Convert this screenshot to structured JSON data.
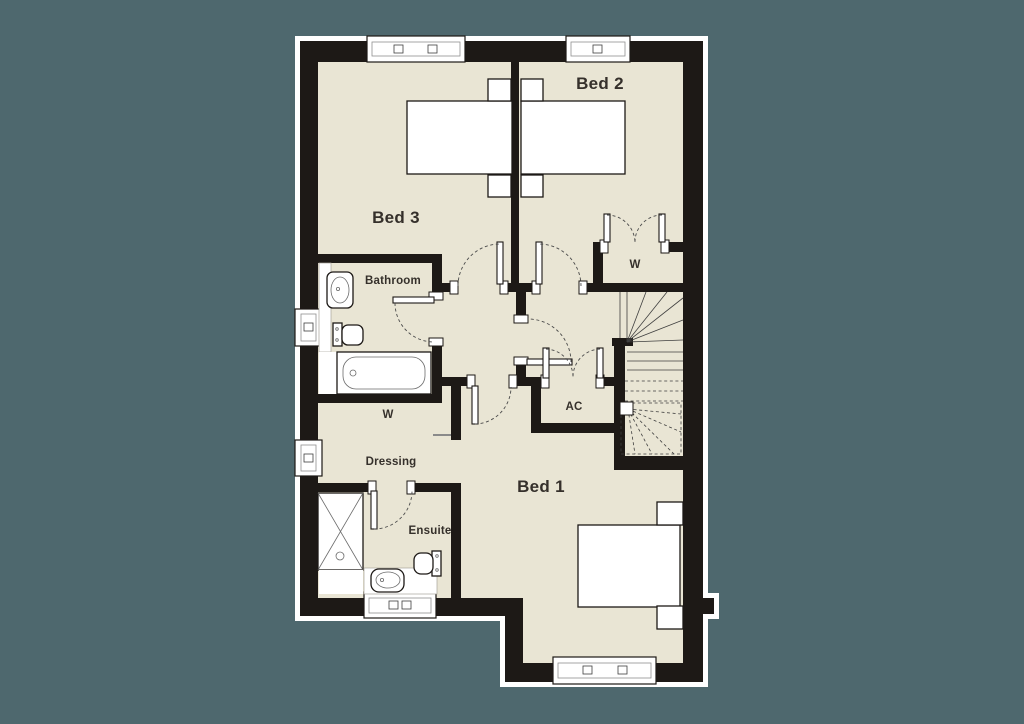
{
  "colors": {
    "background": "#4e686e",
    "floor": "#e9e5d4",
    "wall": "#1d1916",
    "fixture": "#ffffff",
    "text": "#35302b"
  },
  "rooms": {
    "bed1": {
      "label": "Bed 1"
    },
    "bed2": {
      "label": "Bed 2"
    },
    "bed3": {
      "label": "Bed 3"
    },
    "bathroom": {
      "label": "Bathroom"
    },
    "ensuite": {
      "label": "Ensuite"
    },
    "dressing": {
      "label": "Dressing"
    },
    "wardrobe_bed2": {
      "label": "W"
    },
    "wardrobe_dressing": {
      "label": "W"
    },
    "airing_cupboard": {
      "label": "AC"
    }
  }
}
